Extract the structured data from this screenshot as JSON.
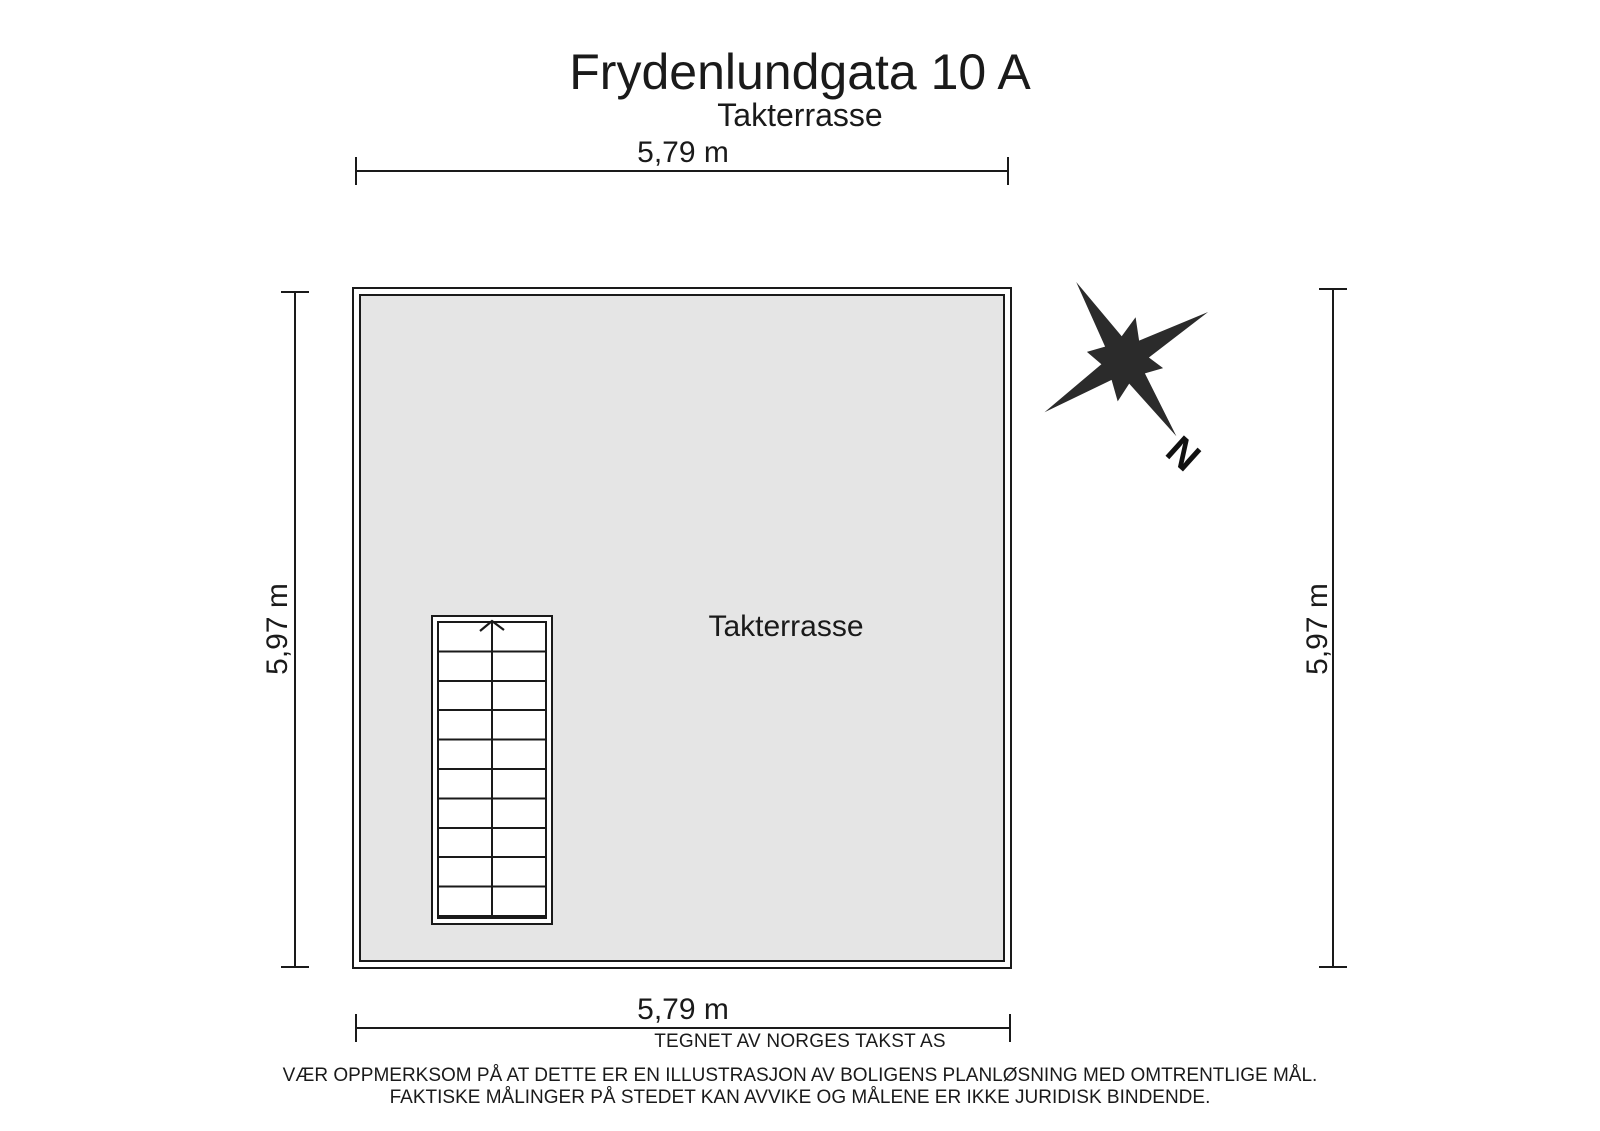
{
  "title": "Frydenlundgata 10 A",
  "subtitle": "Takterrasse",
  "room": {
    "label": "Takterrasse"
  },
  "dimensions": {
    "top": "5,79 m",
    "bottom": "5,79 m",
    "left": "5,97 m",
    "right": "5,97 m"
  },
  "compass": {
    "north_label": "N"
  },
  "footer": {
    "credit": "TEGNET AV NORGES TAKST AS",
    "disclaimer_line1": "VÆR OPPMERKSOM PÅ AT DETTE ER EN ILLUSTRASJON AV BOLIGENS PLANLØSNING MED OMTRENTLIGE MÅL.",
    "disclaimer_line2": "FAKTISKE MÅLINGER PÅ STEDET KAN AVVIKE OG MÅLENE ER IKKE JURIDISK BINDENDE."
  },
  "colors": {
    "line": "#1a1a1a",
    "floor_fill": "#e5e5e5",
    "compass_fill": "#2b2b2b"
  }
}
